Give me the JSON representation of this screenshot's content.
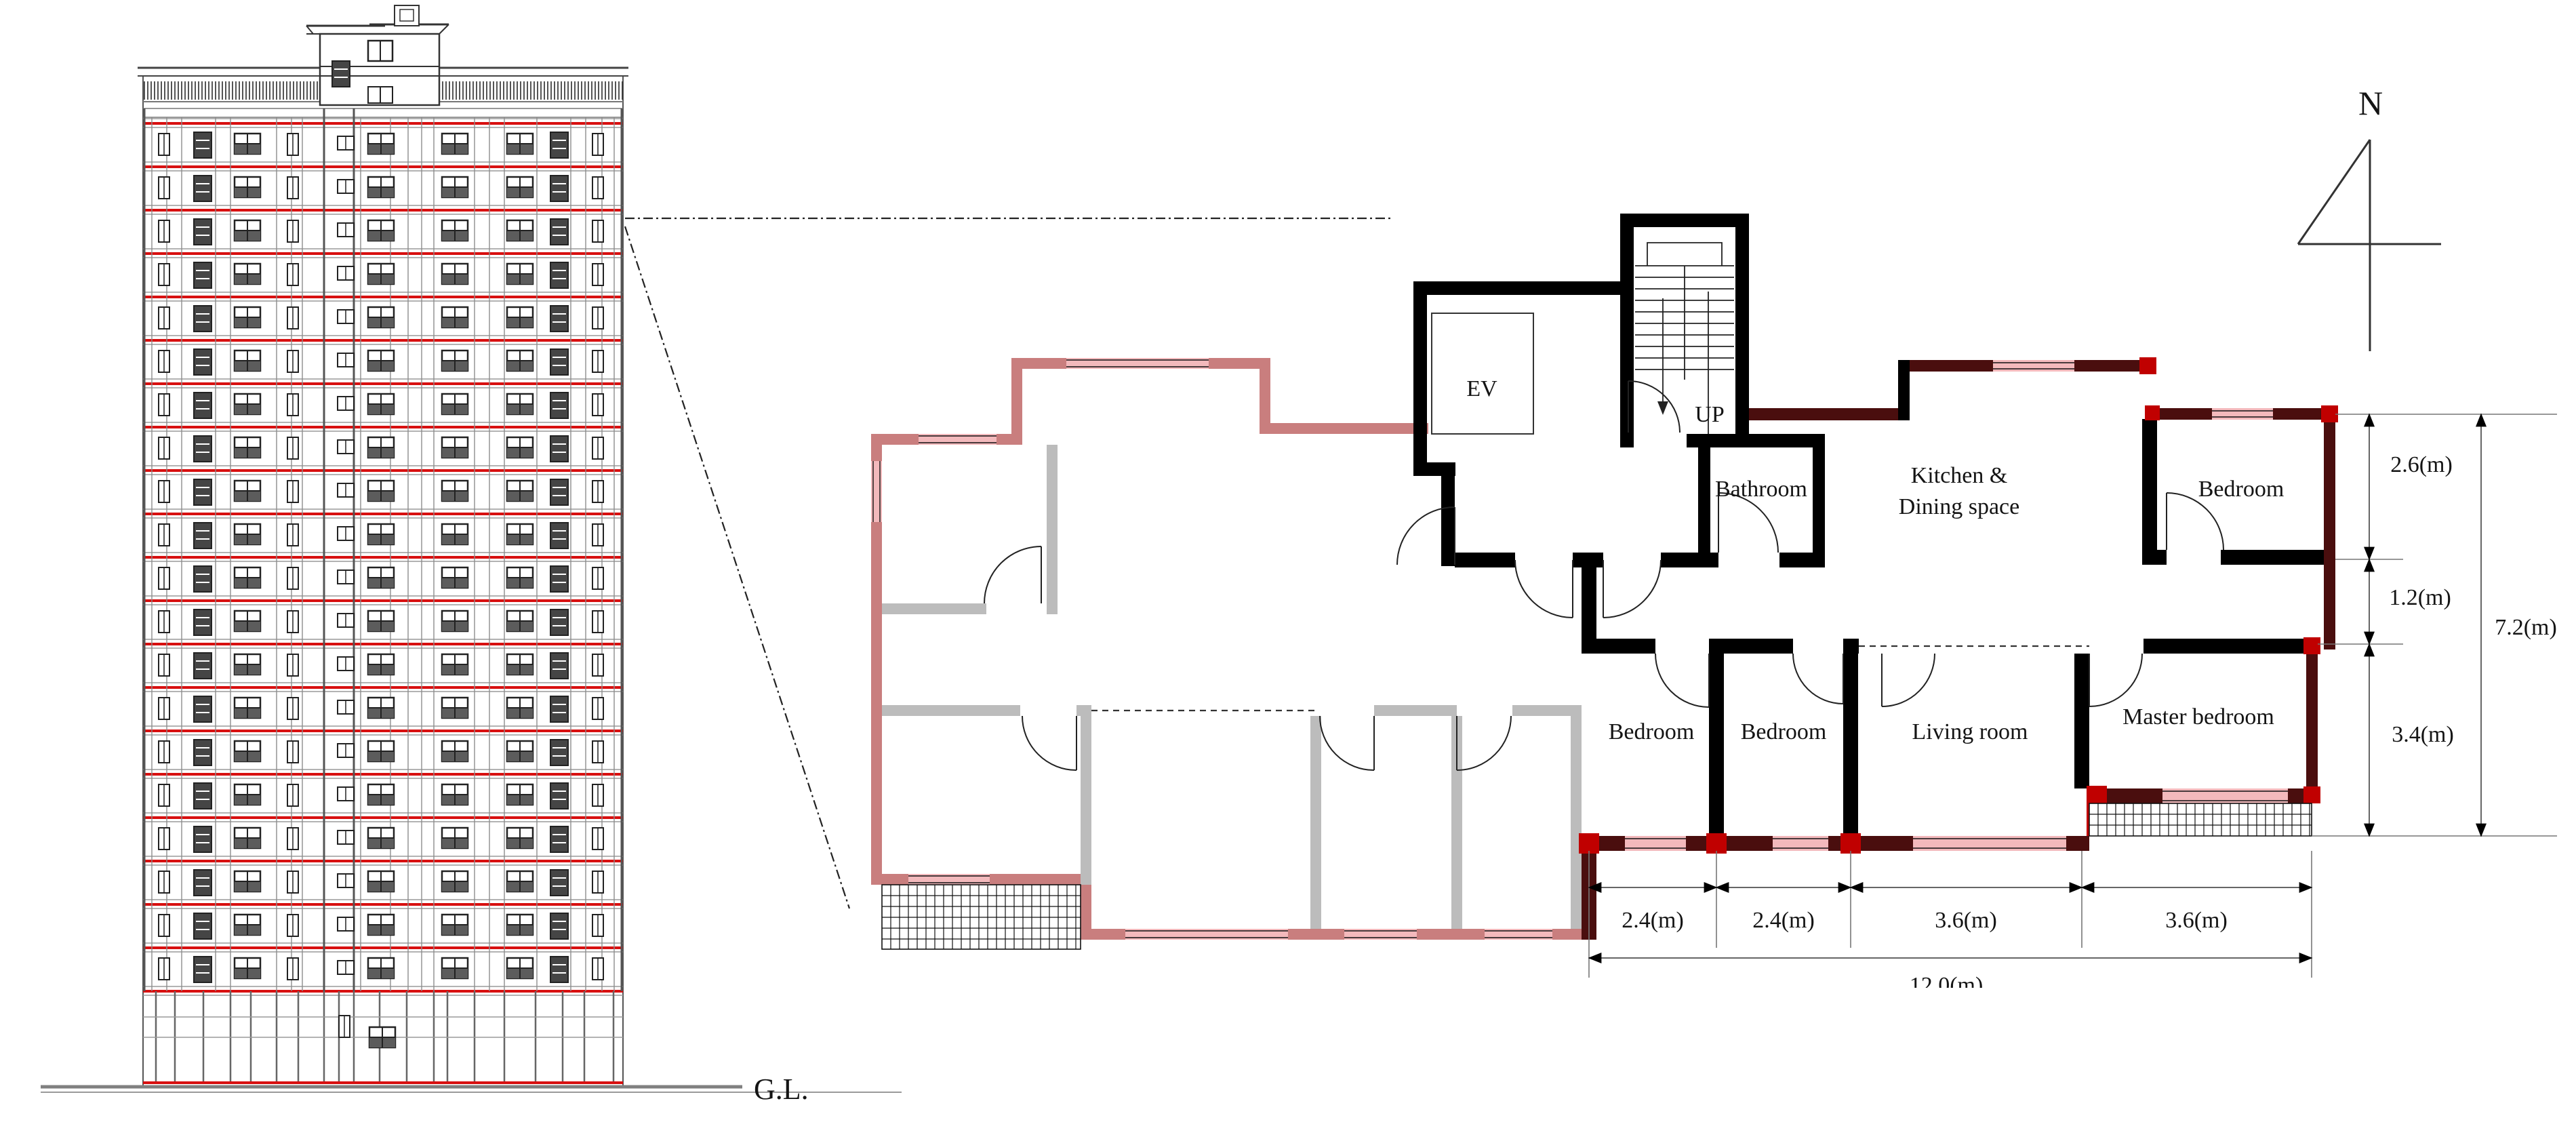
{
  "figure": {
    "type": "architectural-drawing",
    "views": [
      "building-elevation",
      "typical-floor-plan"
    ]
  },
  "elevation": {
    "ground_label": "G.L.",
    "floors": 21,
    "has_penthouse": true
  },
  "plan": {
    "north_label": "N",
    "rooms": {
      "ev": "EV",
      "stairs": "UP",
      "bathroom": "Bathroom",
      "kitchen_line1": "Kitchen &",
      "kitchen_line2": "Dining space",
      "bedroom_ne": "Bedroom",
      "bedroom_1": "Bedroom",
      "bedroom_2": "Bedroom",
      "living": "Living room",
      "master": "Master bedroom"
    },
    "dims_right": [
      {
        "label": "2.6(m)"
      },
      {
        "label": "1.2(m)"
      },
      {
        "label": "3.4(m)"
      },
      {
        "label": "7.2(m)"
      }
    ],
    "dims_bottom": [
      {
        "label": "2.4(m)"
      },
      {
        "label": "2.4(m)"
      },
      {
        "label": "3.6(m)"
      },
      {
        "label": "3.6(m)"
      },
      {
        "label": "12.0(m)"
      }
    ]
  },
  "colors": {
    "slab_red": "#d81010",
    "wall_black": "#000000",
    "wall_dark_red": "#4a0e0e",
    "joint_red": "#c00000",
    "wall_pink": "#c97e7e",
    "window_pink": "#f3b9bc",
    "wall_gray": "#bcbcbc",
    "line_dark": "#222222",
    "dim_line": "#666666",
    "elev_line": "#555555"
  }
}
